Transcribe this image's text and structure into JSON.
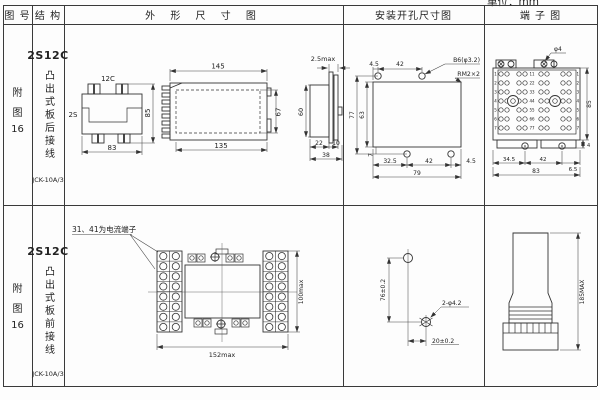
{
  "page": {
    "unit_label": "单位：mm"
  },
  "headers": {
    "fig_no": "图 号",
    "structure": "结 构",
    "outline": "外 形 尺 寸 图",
    "mounting": "安装开孔尺寸图",
    "terminal": "端 子 图"
  },
  "row1": {
    "figure_lines": [
      "附",
      "图",
      "16"
    ],
    "structure": {
      "model": "2S12C",
      "type": "凸出式板后接线",
      "product": "JCK-10A/3"
    },
    "outline": {
      "top_view": {
        "label_top": "12C",
        "label_left": "2S",
        "width": "83",
        "height": "85"
      },
      "side_view": {
        "width_top": "145",
        "width_bottom": "135",
        "height": "67"
      },
      "end_view": {
        "thickness": "2.5max",
        "height": "60",
        "d1": "22",
        "d2": "10",
        "d3": "38"
      }
    },
    "mounting": {
      "top_d1": "4.5",
      "top_d2": "42",
      "hole_label": "B6(φ3.2)",
      "thread_label": "RM2×2",
      "left_total": "77",
      "left_inner": "63",
      "left_offset": "7",
      "bottom_d1": "32.5",
      "bottom_d2": "42",
      "bottom_d3": "4.5",
      "bottom_total": "79"
    },
    "terminal": {
      "top_label": "φ4",
      "row_labels": [
        "1",
        "2",
        "3",
        "4",
        "5",
        "6",
        "7"
      ],
      "center_labels": [
        "11",
        "22",
        "33",
        "44",
        "55",
        "66",
        "77"
      ],
      "bottom_d1": "34.5",
      "bottom_d2": "42",
      "bottom_d3": "6.5",
      "bottom_total": "83",
      "right_height": "85",
      "right_offset": "4"
    }
  },
  "row2": {
    "figure_lines": [
      "附",
      "图",
      "16"
    ],
    "structure": {
      "model": "2S12C",
      "type": "凸出式板前接线",
      "product": "JCK-10A/3"
    },
    "outline": {
      "note": "31、41为电流端子",
      "width": "152max",
      "height": "100max"
    },
    "mounting": {
      "vertical_dim": "76±0.2",
      "horizontal_dim": "20±0.2",
      "holes_label": "2-φ4.2"
    },
    "terminal": {
      "height_dim": "185MAX"
    }
  }
}
